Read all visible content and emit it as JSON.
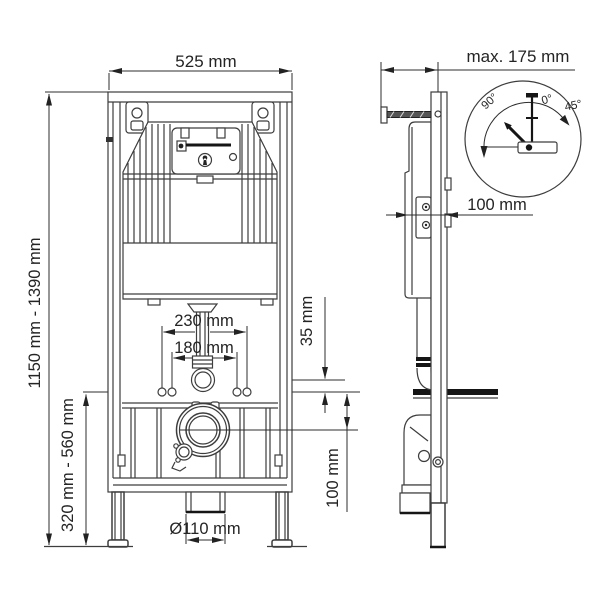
{
  "drawing": {
    "front": {
      "width_label": "525 mm",
      "outer_bolt_label": "230 mm",
      "inner_bolt_label": "180 mm",
      "flush_offset_label": "35 mm",
      "drain_offset_label": "100 mm",
      "height_label": "1150 mm - 1390 mm",
      "fixing_height_label": "320 mm - 560 mm",
      "drain_dia_label": "Ø110 mm"
    },
    "side": {
      "wall_distance_label": "max. 175 mm",
      "depth_label": "100 mm",
      "rotation": {
        "a90": "90°",
        "a0": "0°",
        "a45": "45°"
      }
    },
    "colors": {
      "line": "#3d3d3d",
      "bold": "#151515",
      "text": "#242424",
      "bg": "#ffffff"
    }
  }
}
